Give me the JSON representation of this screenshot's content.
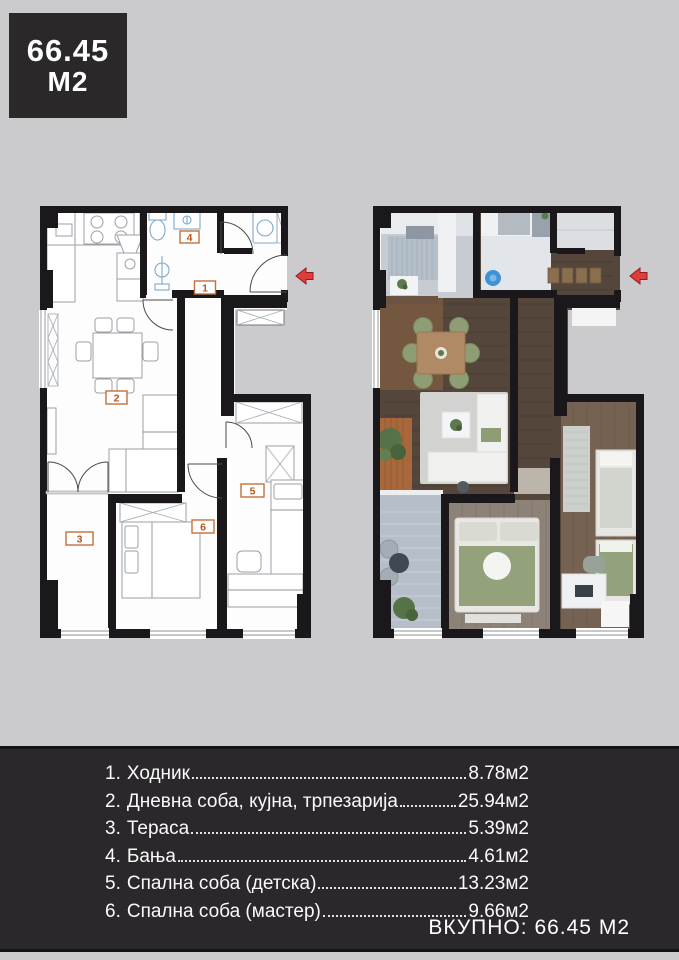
{
  "badge": {
    "line1": "66.45",
    "line2": "M2"
  },
  "floorplan": {
    "room_labels": {
      "r1": "1",
      "r2": "2",
      "r3": "3",
      "r4": "4",
      "r5": "5",
      "r6": "6"
    }
  },
  "legend": {
    "rows": [
      {
        "num": "1.",
        "name": "Ходник",
        "value": "8.78м2"
      },
      {
        "num": "2.",
        "name": "Дневна соба, кујна, трпезарија",
        "value": "25.94м2"
      },
      {
        "num": "3.",
        "name": "Тераса",
        "value": "5.39м2"
      },
      {
        "num": "4.",
        "name": "Бања",
        "value": "4.61м2"
      },
      {
        "num": "5.",
        "name": "Спална соба (детска)",
        "value": "13.23м2"
      },
      {
        "num": "6.",
        "name": "Спална соба (мастер)",
        "value": "9.66м2"
      }
    ],
    "total": "ВКУПНО: 66.45 М2"
  },
  "colors": {
    "background": "#cbcacc",
    "panel": "#2b282b",
    "wall": "#1a181a",
    "accent_red": "#e23b3b",
    "label_orange": "#b9541c"
  }
}
